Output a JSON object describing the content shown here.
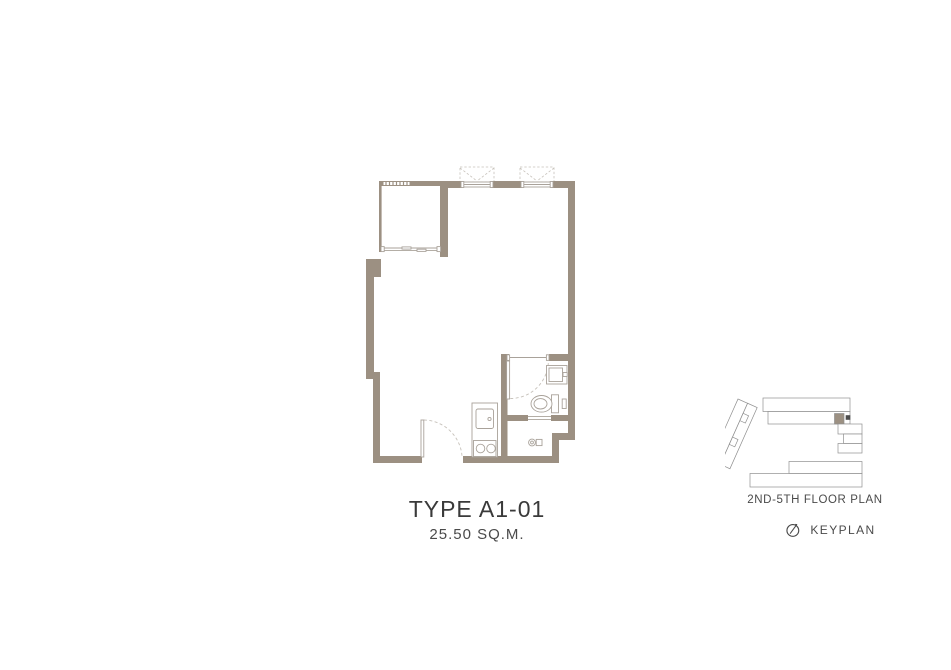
{
  "unit": {
    "type_label": "TYPE A1-01",
    "area_label": "25.50 SQ.M."
  },
  "keyplan": {
    "floor_label": "2ND-5TH FLOOR PLAN",
    "label": "KEYPLAN",
    "icon": "compass-north-icon"
  },
  "floorplan": {
    "rooms": [
      "balcony",
      "living-sleeping-area",
      "bathroom",
      "kitchenette",
      "utility-nook"
    ],
    "fixtures": [
      "louver-vent",
      "sliding-door",
      "ac-condenser-ledge-1",
      "ac-condenser-ledge-2",
      "window-1",
      "window-2",
      "entrance-door",
      "bathroom-door",
      "bathroom-sink",
      "toilet",
      "kitchen-counter",
      "kitchen-sink",
      "two-burner-stove",
      "washer-tap"
    ]
  },
  "colors": {
    "wall": "#9c9082",
    "fixture_line": "#a9a29a",
    "dash_line": "#c7c2bb",
    "keyplan_line": "#8f8f8f",
    "keyplan_unit_line": "#9a9a9a",
    "highlight_unit": "#9c9082",
    "core_dark": "#4d4d4d",
    "text_primary": "#3a3a3a",
    "text_secondary": "#4a4a4a",
    "page_bg": "#ffffff"
  }
}
